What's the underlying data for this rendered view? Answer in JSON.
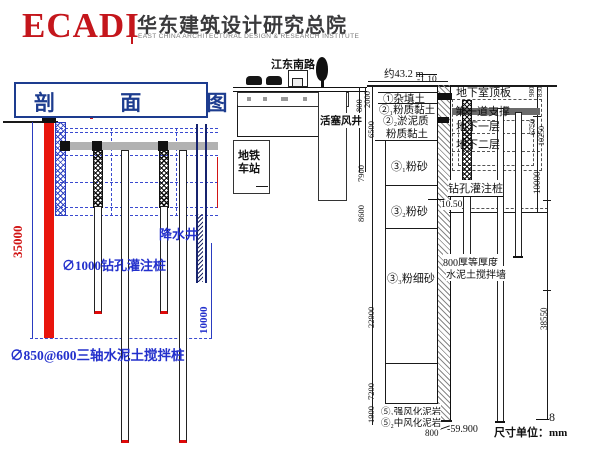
{
  "colors": {
    "logo_red": "#c4161c",
    "title_navy": "#1d3c8f",
    "drawing_blue": "#2330cc",
    "wall_red": "#e8150d"
  },
  "header": {
    "logo": "ECADI",
    "org_cn": "华东建筑设计研究总院",
    "org_en": "EAST CHINA ARCHITECTURAL DESIGN & RESEARCH INSTITUTE"
  },
  "title": {
    "text": "剖 面 图"
  },
  "left": {
    "dim_35000": "35000",
    "dim_10000": "10000",
    "well": "降水井",
    "bored_pile": "∅1000钻孔灌注桩",
    "mixing_pile": "∅850@600三轴水泥土搅拌桩"
  },
  "middle": {
    "road": "江东南路",
    "piston_shaft": "活塞风井",
    "station_line1": "地铁",
    "station_line2": "车站"
  },
  "geo": {
    "width_note": "约43.2 m",
    "elev_top": "-1.10",
    "dims": {
      "d2000": "2000",
      "d800": "800",
      "d6500": "6500",
      "d7900": "7900",
      "d8600": "8600",
      "d22900": "22900",
      "d7200": "7200",
      "d1900": "1900"
    },
    "layers": {
      "l1": "①杂填土",
      "l2a": "②₁粉质黏土",
      "l2b1": "②₂淤泥质",
      "l2b2": "粉质黏土",
      "l3a": "③₁粉砂",
      "l3b": "③₂粉砂",
      "l3c": "③₃粉细砂",
      "l5a": "⑤₁强风化泥岩",
      "l5b": "⑤₂中风化泥岩"
    }
  },
  "structure": {
    "roof": "地下室顶板",
    "first_strut": "第一道支撑",
    "b1": "地下一层",
    "b2": "地下二层",
    "pile": "钻孔灌注桩",
    "elev_strut": "10.50",
    "wall_note1": "800厚等厚度",
    "wall_note2": "水泥土搅拌墙",
    "dims": {
      "d980": "980",
      "d830": "830",
      "d6750": "6750",
      "d10250": "10250",
      "d10000": "10000",
      "d38550": "38550"
    },
    "bottom": {
      "wall_800": "800",
      "elev": "-59.900",
      "unit_label": "尺寸单位：",
      "unit_value": "mm",
      "page": "8"
    }
  }
}
